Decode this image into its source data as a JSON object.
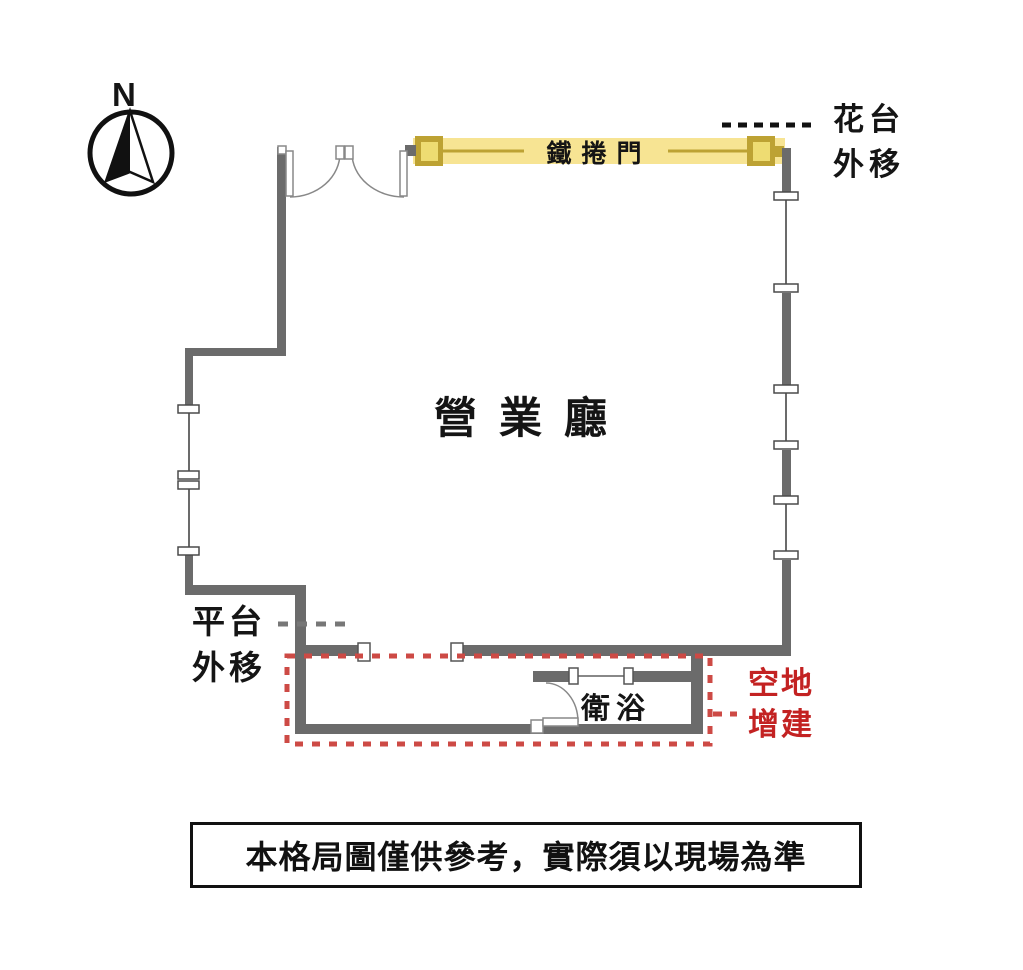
{
  "diagram": {
    "type": "floor-plan",
    "compass": {
      "label": "N",
      "direction": "north-up"
    },
    "rooms": {
      "hall": "營業廳",
      "bath": "衛浴"
    },
    "annotations": {
      "roller_door": {
        "text": "鐵捲門",
        "highlight": "yellow-band"
      },
      "flower_bed": {
        "line1": "花台",
        "line2": "外移",
        "leader": "black-dotted"
      },
      "platform": {
        "line1": "平台",
        "line2": "外移",
        "leader": "gray-dashed"
      },
      "vacant_addition": {
        "line1": "空地",
        "line2": "增建",
        "leader": "red-dotted",
        "outline": "red-dotted-rectangle"
      }
    },
    "disclaimer": "本格局圖僅供參考，實際須以現場為準"
  },
  "colors": {
    "background": "#ffffff",
    "wall_gray": "#6b6b6b",
    "ink": "#111111",
    "roller_band_yellow": "#f7e493",
    "roller_accent_olive": "#bda233",
    "roller_inner_yellow": "#eedc72",
    "annotation_red": "#c32222",
    "dash_red": "#cd4a45",
    "leader_gray": "#777777"
  }
}
